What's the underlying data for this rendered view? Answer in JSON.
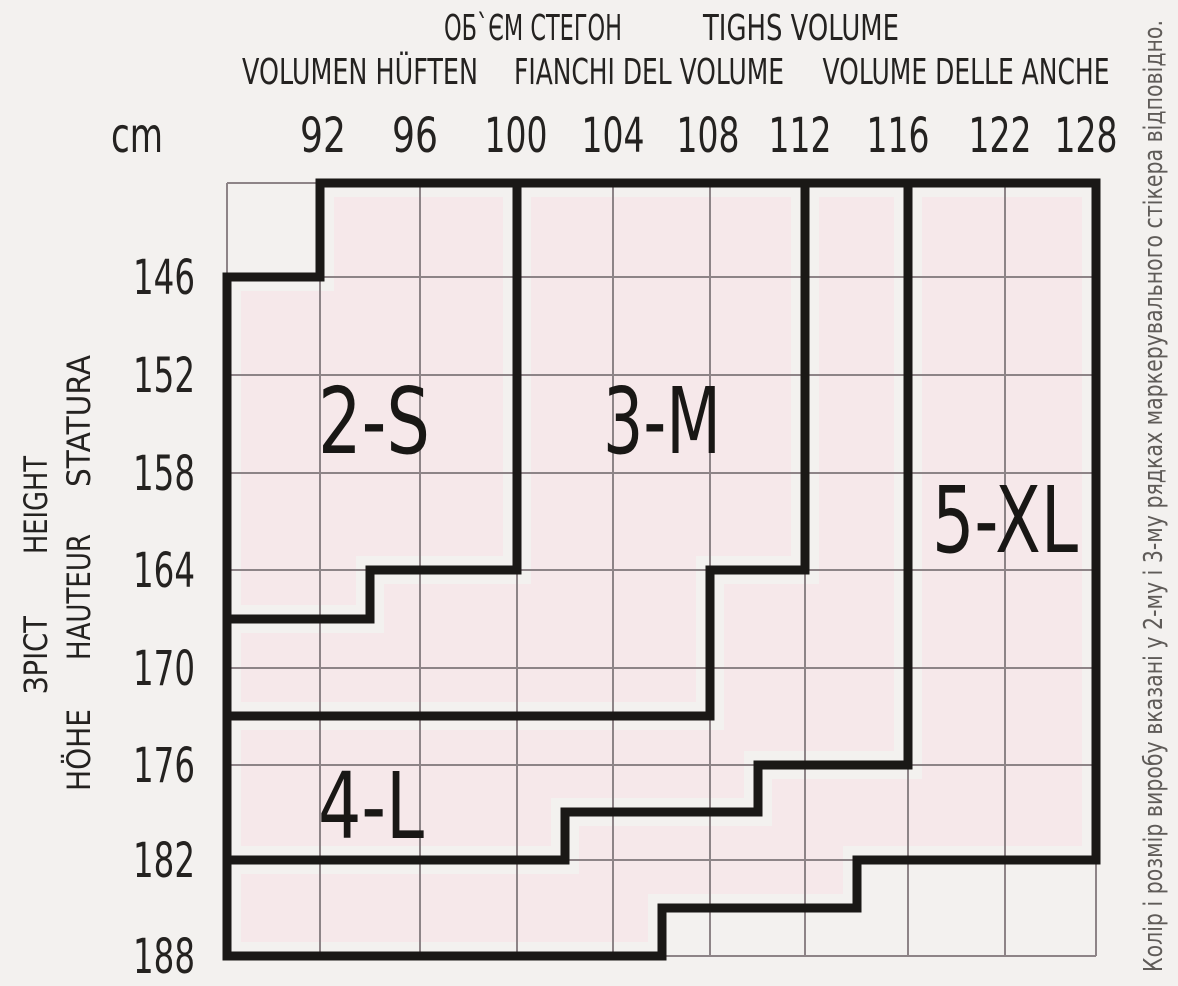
{
  "page": {
    "background": "#f3f1ef"
  },
  "header": {
    "volume_uk": "ОБ`ЄМ СТЕГОН",
    "volume_en": "TIGHS VOLUME",
    "volume_de": "VOLUMEN HÜFTEN",
    "volume_it": "FIANCHI DEL VOLUME",
    "volume_it2": "VOLUME DELLE ANCHE"
  },
  "left_axis": {
    "it": "STATURA",
    "en": "HEIGHT",
    "fr": "HAUTEUR",
    "uk": "ЗРІСТ",
    "de": "HÖHE"
  },
  "side_note": "Колір і розмір виробу вказані у 2-му і 3-му рядках маркерувального стікера відповідно.",
  "chart_data": {
    "type": "heatmap",
    "title": "ОБ`ЄМ СТЕГОН / TIGHS VOLUME — size zones by height and hip volume",
    "xlabel": "hip volume (cm)",
    "ylabel": "height (cm)",
    "x_axis": {
      "unit": "cm",
      "unit_x": 137,
      "baseline_y": 152,
      "tick_values": [
        "92",
        "96",
        "100",
        "104",
        "108",
        "112",
        "116",
        "122",
        "128"
      ],
      "tick_x": [
        323,
        415,
        516,
        613,
        708,
        800,
        898,
        1000,
        1086
      ]
    },
    "y_axis": {
      "label_x": 164,
      "tick_values": [
        "146",
        "152",
        "158",
        "164",
        "170",
        "176",
        "182",
        "188"
      ],
      "tick_y": [
        277,
        375,
        473,
        570,
        668,
        765,
        860,
        956
      ]
    },
    "frame": {
      "left": 227,
      "top": 183,
      "right": 1096,
      "bottom": 956
    },
    "grid_x": [
      227,
      320,
      420,
      517,
      613,
      710,
      805,
      908,
      1005,
      1096
    ],
    "grid_y": [
      183,
      277,
      375,
      473,
      570,
      668,
      765,
      860,
      956
    ],
    "grid_on": true,
    "colors": {
      "background": "#f3f1ef",
      "zone_fill": "#f6e8ea",
      "grid_line": "#8d8487",
      "outline": "#1a1816",
      "text": "#242220",
      "note_text": "#5f5b58"
    },
    "zones": [
      {
        "name": "2-S",
        "label_x": 374,
        "label_y": 453,
        "label_len": 112,
        "outline": [
          [
            320,
            183
          ],
          [
            517,
            183
          ],
          [
            517,
            570
          ],
          [
            370,
            570
          ],
          [
            370,
            619
          ],
          [
            227,
            619
          ],
          [
            227,
            277
          ],
          [
            320,
            277
          ]
        ],
        "fill": [
          [
            334,
            197
          ],
          [
            503,
            197
          ],
          [
            503,
            556
          ],
          [
            356,
            556
          ],
          [
            356,
            605
          ],
          [
            241,
            605
          ],
          [
            241,
            291
          ],
          [
            334,
            291
          ]
        ]
      },
      {
        "name": "3-M",
        "label_x": 662,
        "label_y": 453,
        "label_len": 118,
        "outline": [
          [
            517,
            183
          ],
          [
            805,
            183
          ],
          [
            805,
            570
          ],
          [
            710,
            570
          ],
          [
            710,
            716
          ],
          [
            227,
            716
          ],
          [
            227,
            619
          ],
          [
            370,
            619
          ],
          [
            370,
            570
          ],
          [
            517,
            570
          ]
        ],
        "fill": [
          [
            531,
            197
          ],
          [
            791,
            197
          ],
          [
            791,
            556
          ],
          [
            696,
            556
          ],
          [
            696,
            702
          ],
          [
            241,
            702
          ],
          [
            241,
            633
          ],
          [
            384,
            633
          ],
          [
            384,
            584
          ],
          [
            531,
            584
          ]
        ]
      },
      {
        "name": "4-L",
        "label_x": 371,
        "label_y": 838,
        "label_len": 106,
        "outline": [
          [
            805,
            183
          ],
          [
            908,
            183
          ],
          [
            908,
            765
          ],
          [
            758,
            765
          ],
          [
            758,
            812
          ],
          [
            565,
            812
          ],
          [
            565,
            860
          ],
          [
            227,
            860
          ],
          [
            227,
            716
          ],
          [
            710,
            716
          ],
          [
            710,
            570
          ],
          [
            805,
            570
          ]
        ],
        "fill": [
          [
            819,
            197
          ],
          [
            894,
            197
          ],
          [
            894,
            751
          ],
          [
            744,
            751
          ],
          [
            744,
            798
          ],
          [
            551,
            798
          ],
          [
            551,
            846
          ],
          [
            241,
            846
          ],
          [
            241,
            730
          ],
          [
            724,
            730
          ],
          [
            724,
            584
          ],
          [
            819,
            584
          ]
        ]
      },
      {
        "name": "5-XL",
        "label_x": 1005,
        "label_y": 552,
        "label_len": 146,
        "outline": [
          [
            908,
            183
          ],
          [
            1096,
            183
          ],
          [
            1096,
            860
          ],
          [
            857,
            860
          ],
          [
            857,
            908
          ],
          [
            662,
            908
          ],
          [
            662,
            956
          ],
          [
            227,
            956
          ],
          [
            227,
            860
          ],
          [
            565,
            860
          ],
          [
            565,
            812
          ],
          [
            758,
            812
          ],
          [
            758,
            765
          ],
          [
            908,
            765
          ]
        ],
        "fill": [
          [
            922,
            197
          ],
          [
            1082,
            197
          ],
          [
            1082,
            846
          ],
          [
            843,
            846
          ],
          [
            843,
            894
          ],
          [
            648,
            894
          ],
          [
            648,
            942
          ],
          [
            241,
            942
          ],
          [
            241,
            874
          ],
          [
            579,
            874
          ],
          [
            579,
            826
          ],
          [
            772,
            826
          ],
          [
            772,
            779
          ],
          [
            922,
            779
          ]
        ]
      }
    ]
  }
}
